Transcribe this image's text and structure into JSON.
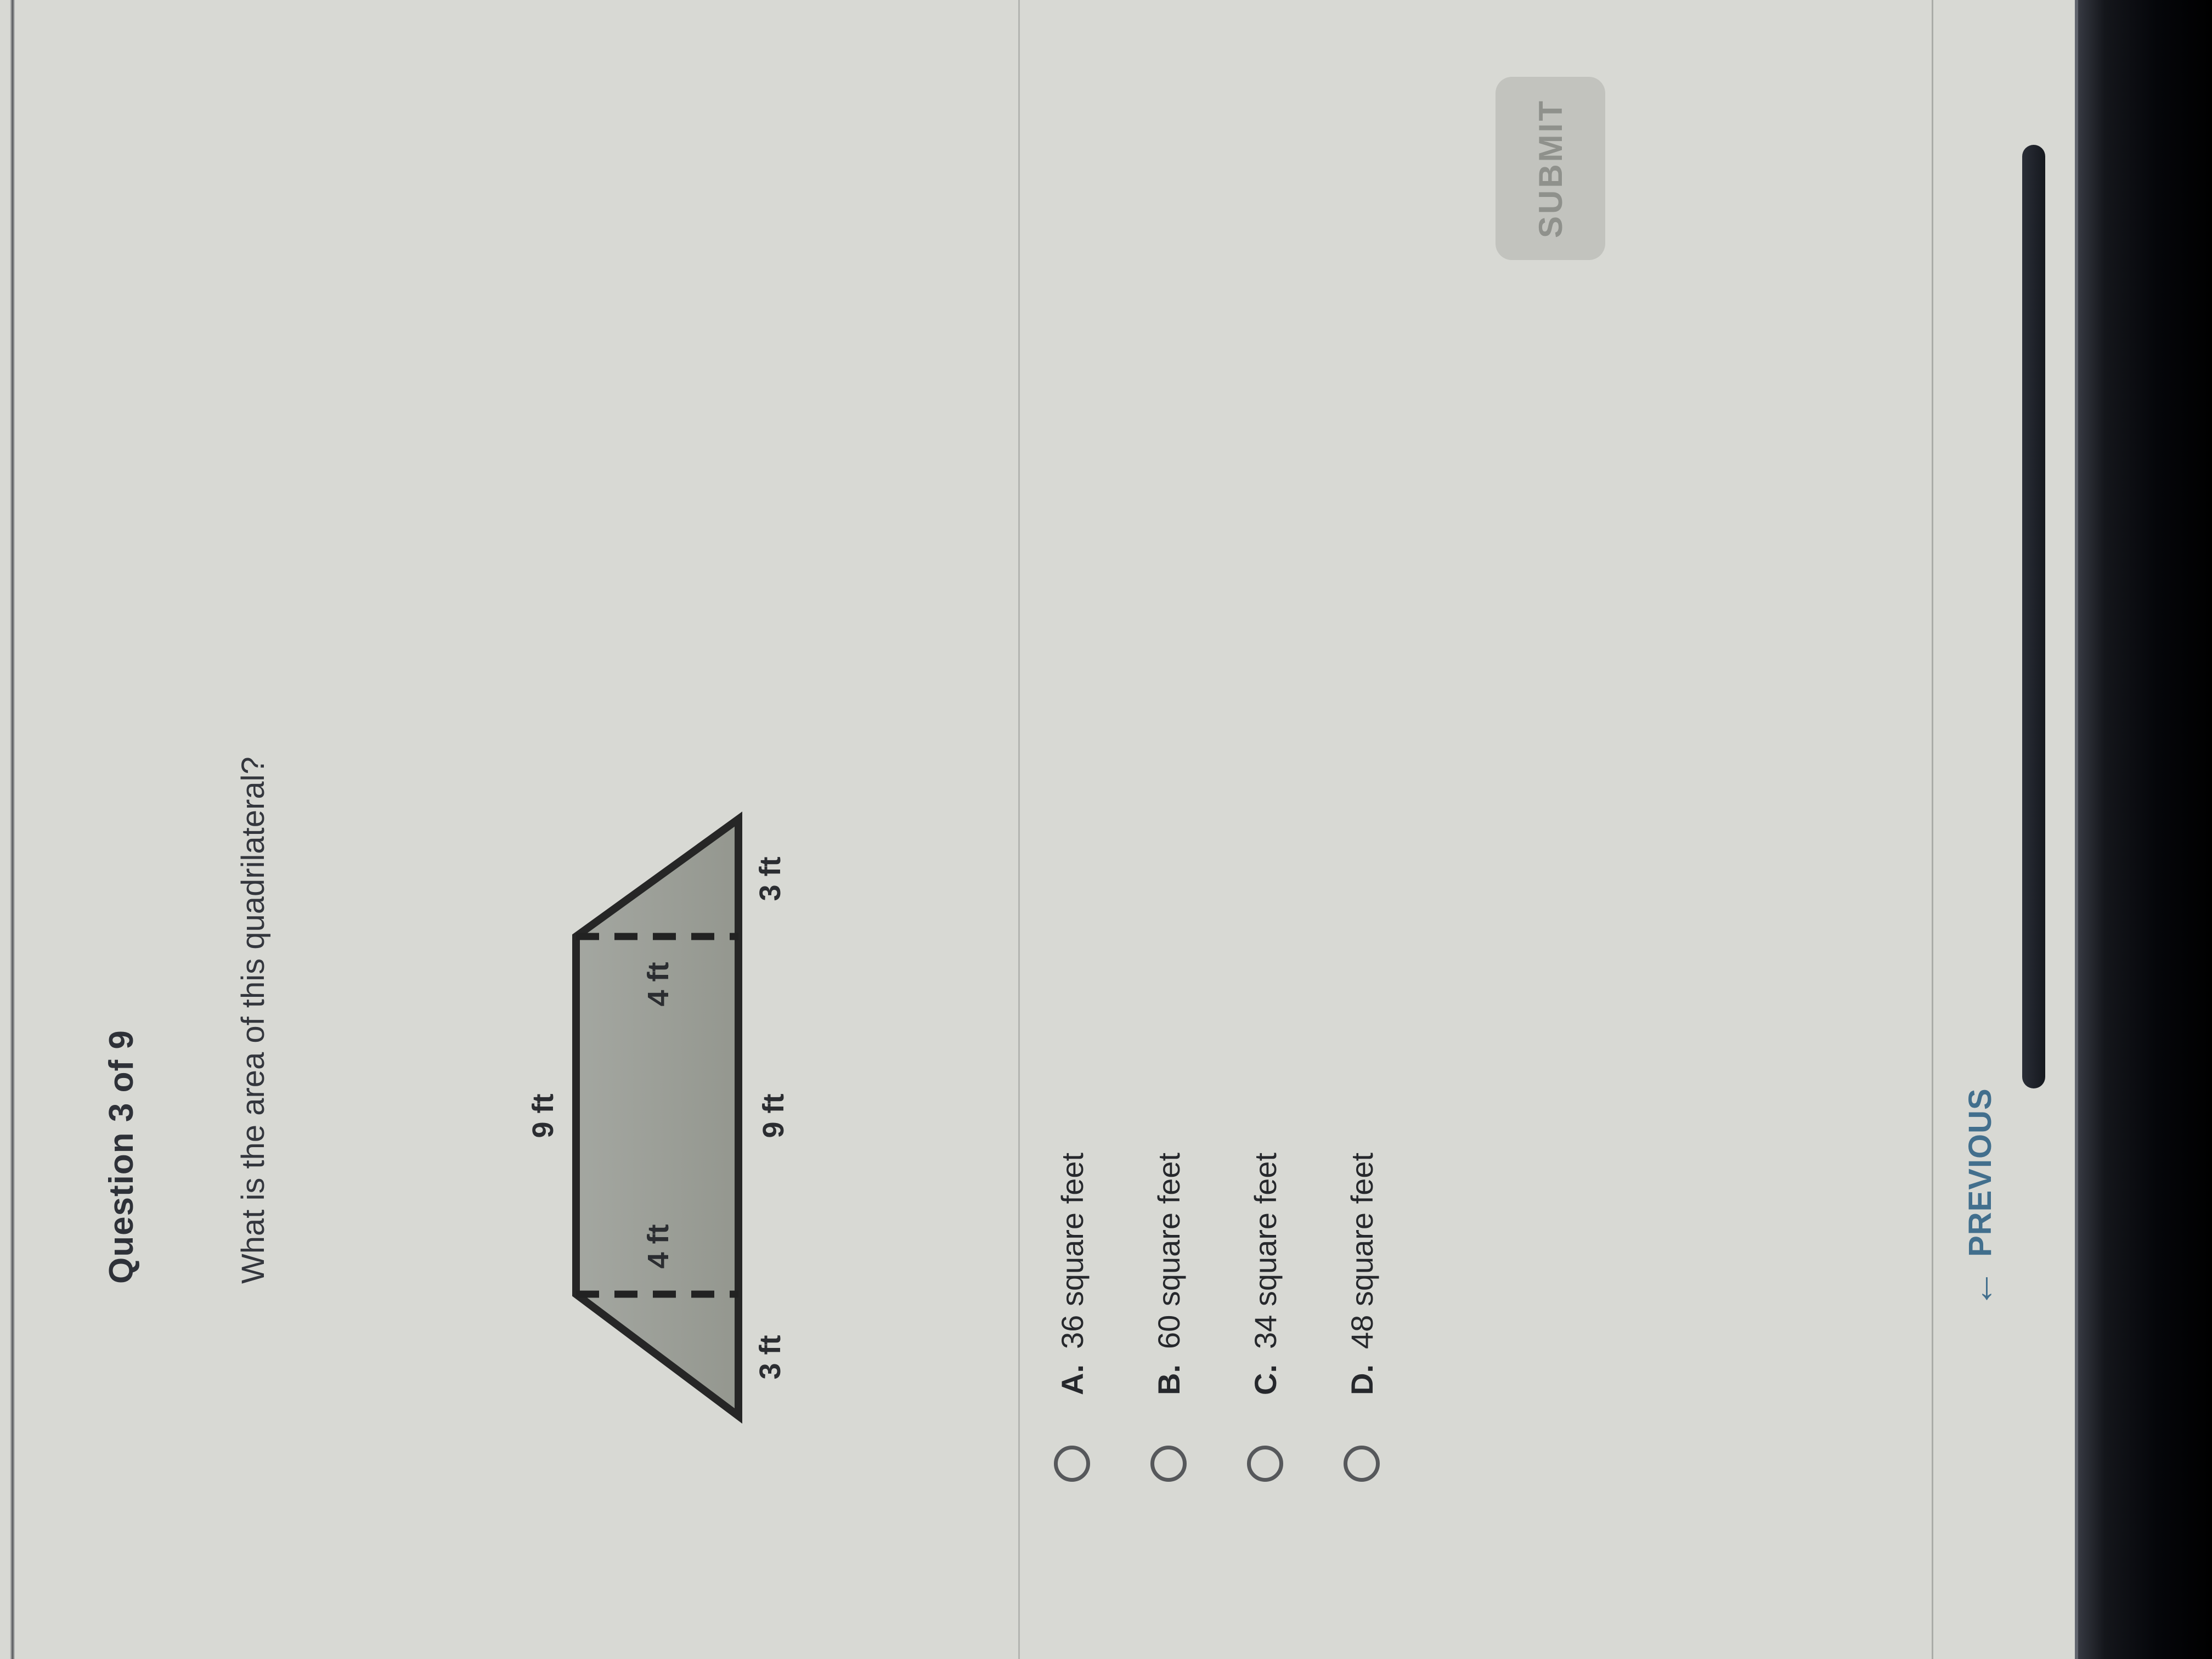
{
  "header": {
    "title": "Question 3 of 9"
  },
  "question": {
    "text": "What is the area of this quadrilateral?"
  },
  "figure": {
    "type": "trapezoid",
    "description": "Isosceles trapezoid, gray fill, wider at the bottom; dashed vertical height lines drop from both top corners",
    "top_edge_label": "9 ft",
    "bottom_middle_label": "9 ft",
    "left_height_label": "4 ft",
    "right_height_label": "4 ft",
    "bottom_left_label": "3 ft",
    "bottom_right_label": "3 ft",
    "fill_color": "#9b9e99",
    "stroke_color": "#262626"
  },
  "options": [
    {
      "letter": "A.",
      "text": "36 square feet",
      "selected": false
    },
    {
      "letter": "B.",
      "text": "60 square feet",
      "selected": false
    },
    {
      "letter": "C.",
      "text": "34 square feet",
      "selected": false
    },
    {
      "letter": "D.",
      "text": "48 square feet",
      "selected": false
    }
  ],
  "actions": {
    "submit_label": "SUBMIT",
    "submit_enabled": false
  },
  "footer": {
    "previous_arrow": "←",
    "previous_label": "PREVIOUS"
  },
  "colors": {
    "page_background": "#d8d9d4",
    "text": "#2e3138",
    "figure_fill": "#9b9e99",
    "previous_link": "#426f8d",
    "submit_background": "#c2c3be",
    "submit_text": "#8f918c",
    "bezel": "#000000"
  }
}
